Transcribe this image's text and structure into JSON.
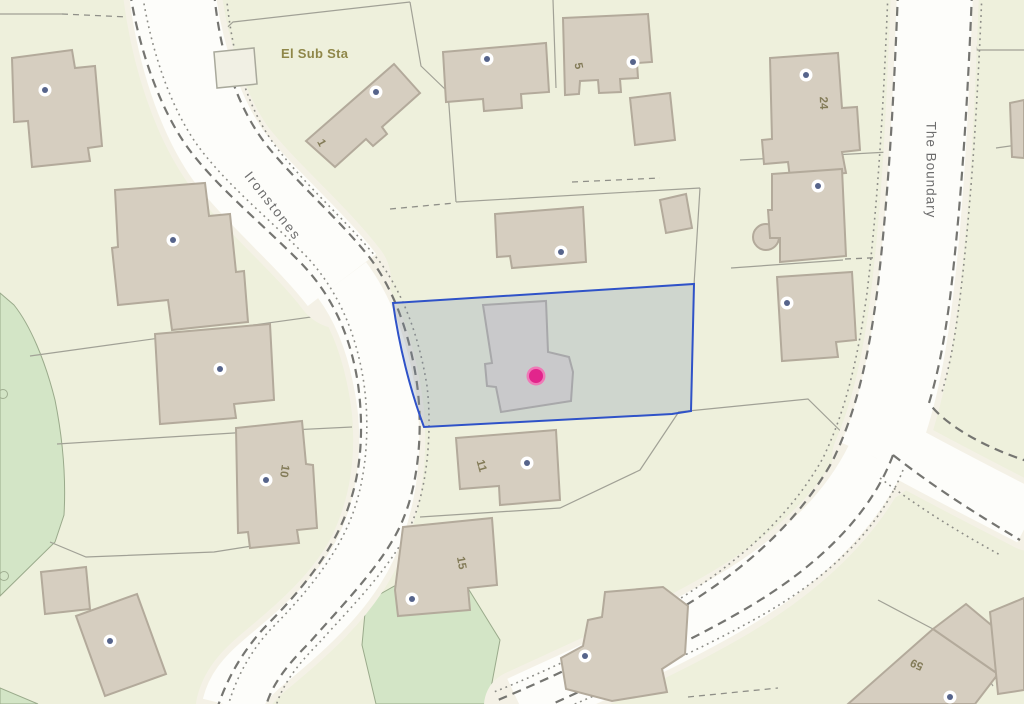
{
  "map": {
    "labels": {
      "substation": "El Sub Sta",
      "street_1": "Ironstones",
      "street_2": "The Boundary"
    },
    "house_numbers": {
      "n1": "1",
      "n5": "5",
      "n24": "24",
      "n10": "10",
      "n11": "11",
      "n15": "15",
      "n59": "59"
    },
    "markers": {
      "selected_property_marker_color": "#e2258c",
      "building_marker_dot_color": "#56648b",
      "building_marker_count": "16"
    },
    "highlight": {
      "parcel_outline_color": "#2f52c8",
      "parcel_fill_color": "#d4d9df"
    },
    "colors": {
      "parcel_background": "#eef0dc",
      "road_fill": "#fdfdfa",
      "road_verge": "#f4f1e6",
      "building_fill": "#d6cec0",
      "selected_building_fill": "#c9c9cb",
      "woodland_fill": "#d3e5c6"
    }
  }
}
